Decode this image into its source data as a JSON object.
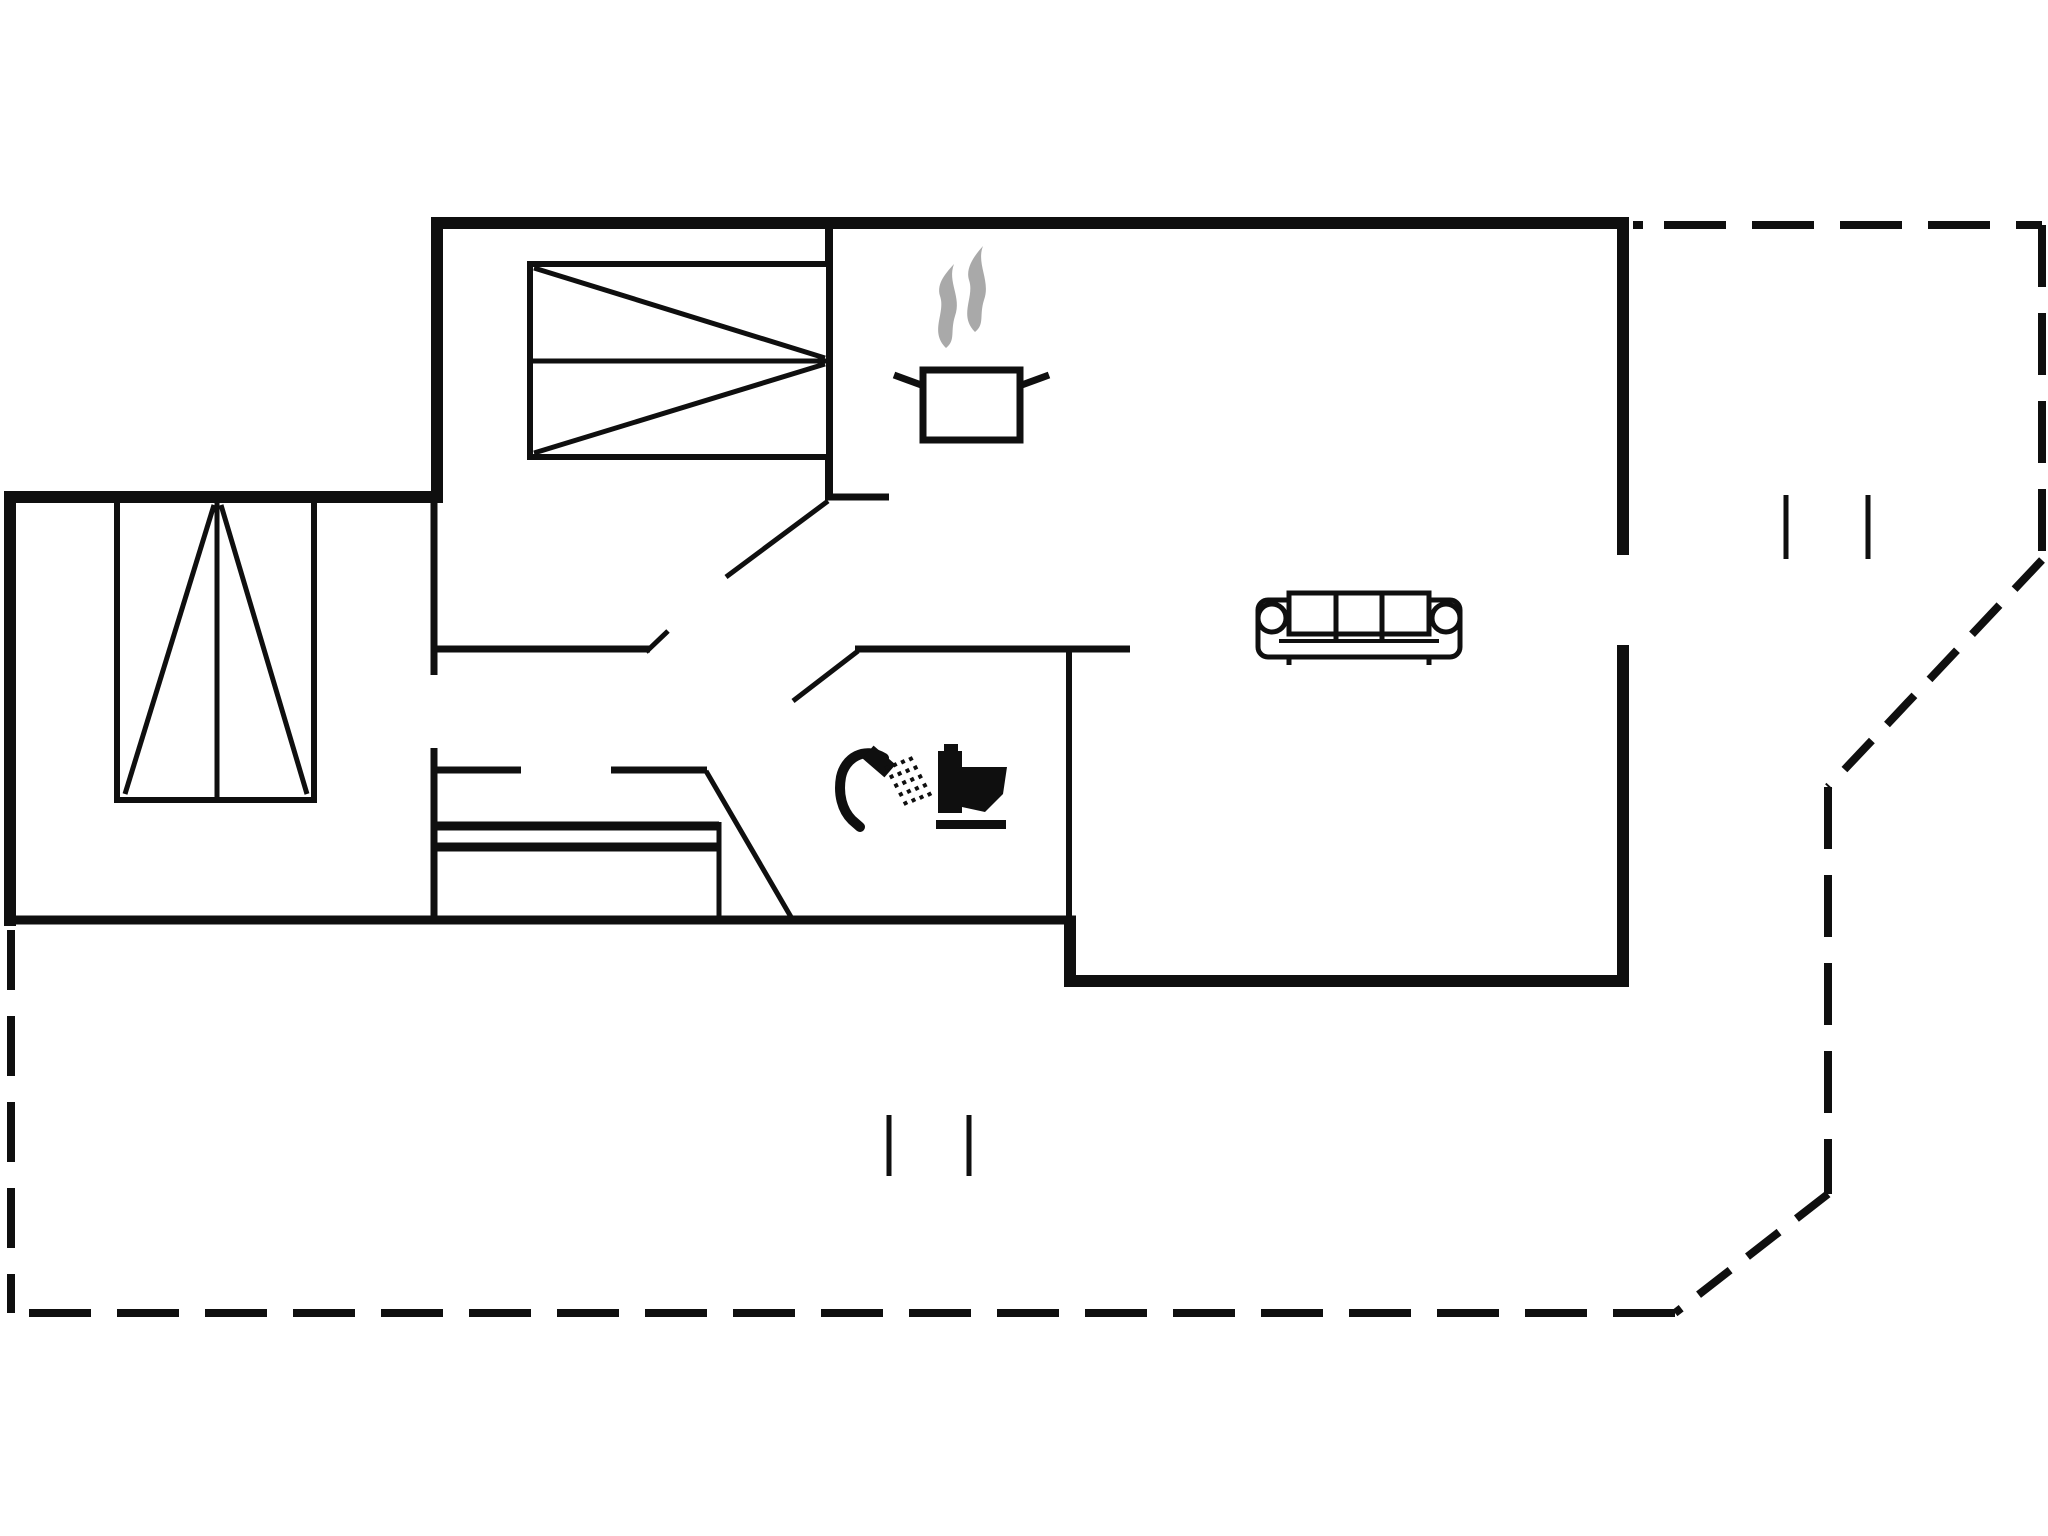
{
  "title": "floor-plan",
  "canvas": {
    "width": 2048,
    "height": 1536,
    "background": "#ffffff",
    "line_color": "#0f0f0f",
    "steam_color": "#a9a9a9"
  },
  "plan": {
    "walls": [
      {
        "x1": 431,
        "y1": 223,
        "x2": 1629,
        "y2": 223,
        "w": 12
      },
      {
        "x1": 437,
        "y1": 217,
        "x2": 437,
        "y2": 503,
        "w": 12
      },
      {
        "x1": 4,
        "y1": 497,
        "x2": 443,
        "y2": 497,
        "w": 12
      },
      {
        "x1": 10,
        "y1": 491,
        "x2": 10,
        "y2": 926,
        "w": 12
      },
      {
        "x1": 4,
        "y1": 920,
        "x2": 1076,
        "y2": 920,
        "w": 9
      },
      {
        "x1": 1070,
        "y1": 916,
        "x2": 1070,
        "y2": 985,
        "w": 12
      },
      {
        "x1": 1064,
        "y1": 981,
        "x2": 1629,
        "y2": 981,
        "w": 12
      },
      {
        "x1": 1623,
        "y1": 217,
        "x2": 1623,
        "y2": 555,
        "w": 12
      },
      {
        "x1": 1623,
        "y1": 645,
        "x2": 1623,
        "y2": 987,
        "w": 12
      },
      {
        "x1": 829,
        "y1": 229,
        "x2": 829,
        "y2": 500,
        "w": 8
      },
      {
        "x1": 827,
        "y1": 497,
        "x2": 889,
        "y2": 497,
        "w": 7
      },
      {
        "x1": 434,
        "y1": 500,
        "x2": 434,
        "y2": 675,
        "w": 7
      },
      {
        "x1": 434,
        "y1": 748,
        "x2": 434,
        "y2": 924,
        "w": 7
      },
      {
        "x1": 431,
        "y1": 649,
        "x2": 650,
        "y2": 649,
        "w": 7
      },
      {
        "x1": 646,
        "y1": 652,
        "x2": 668,
        "y2": 631,
        "w": 5
      },
      {
        "x1": 855,
        "y1": 649,
        "x2": 1130,
        "y2": 649,
        "w": 7
      },
      {
        "x1": 1069,
        "y1": 649,
        "x2": 1069,
        "y2": 924,
        "w": 6
      },
      {
        "x1": 431,
        "y1": 770,
        "x2": 521,
        "y2": 770,
        "w": 7
      },
      {
        "x1": 611,
        "y1": 770,
        "x2": 707,
        "y2": 770,
        "w": 7
      }
    ],
    "doors": [
      {
        "x1": 828,
        "y1": 501,
        "x2": 726,
        "y2": 577,
        "w": 5
      },
      {
        "x1": 858,
        "y1": 651,
        "x2": 793,
        "y2": 701,
        "w": 5
      },
      {
        "x1": 706,
        "y1": 771,
        "x2": 791,
        "y2": 917,
        "w": 5
      }
    ],
    "windows": [
      {
        "x1": 1786,
        "y1": 495,
        "x2": 1786,
        "y2": 559,
        "w": 5
      },
      {
        "x1": 1868,
        "y1": 495,
        "x2": 1868,
        "y2": 559,
        "w": 5
      },
      {
        "x1": 889,
        "y1": 1115,
        "x2": 889,
        "y2": 1176,
        "w": 5
      },
      {
        "x1": 969,
        "y1": 1115,
        "x2": 969,
        "y2": 1176,
        "w": 5
      }
    ],
    "doormat": [
      {
        "x1": 434,
        "y1": 826,
        "x2": 719,
        "y2": 826,
        "w": 9
      },
      {
        "x1": 434,
        "y1": 847,
        "x2": 719,
        "y2": 847,
        "w": 9
      },
      {
        "x1": 719,
        "y1": 822,
        "x2": 719,
        "y2": 918,
        "w": 5
      }
    ],
    "terrace": [
      {
        "x1": 1633,
        "y1": 225,
        "x2": 1643,
        "y2": 225,
        "w": 8,
        "dash": "none"
      },
      {
        "x1": 1664,
        "y1": 225,
        "x2": 2042,
        "y2": 225,
        "w": 8,
        "dash": "62 26"
      },
      {
        "x1": 2042,
        "y1": 225,
        "x2": 2042,
        "y2": 560,
        "w": 8,
        "dash": "62 26"
      },
      {
        "x1": 2042,
        "y1": 560,
        "x2": 1828,
        "y2": 787,
        "w": 8,
        "dash": "40 22"
      },
      {
        "x1": 1828,
        "y1": 787,
        "x2": 1828,
        "y2": 1194,
        "w": 8,
        "dash": "62 26"
      },
      {
        "x1": 1828,
        "y1": 1194,
        "x2": 1675,
        "y2": 1313,
        "w": 8,
        "dash": "40 22"
      },
      {
        "x1": 1675,
        "y1": 1313,
        "x2": 25,
        "y2": 1313,
        "w": 8,
        "dash": "62 26"
      },
      {
        "x1": 11,
        "y1": 930,
        "x2": 11,
        "y2": 1313,
        "w": 8,
        "dash": "60 26"
      }
    ]
  },
  "furniture": [
    {
      "name": "double-bed-icon",
      "prims": [
        {
          "t": "rect",
          "x": 530,
          "y": 264,
          "w": 299,
          "h": 193,
          "sw": 6,
          "fill": "#ffffff"
        },
        {
          "t": "line",
          "x1": 530,
          "y1": 361,
          "x2": 829,
          "y2": 361,
          "sw": 5
        },
        {
          "t": "line",
          "x1": 534,
          "y1": 268,
          "x2": 825,
          "y2": 358,
          "sw": 5
        },
        {
          "t": "line",
          "x1": 534,
          "y1": 453,
          "x2": 825,
          "y2": 364,
          "sw": 5
        }
      ]
    },
    {
      "name": "wardrobe-icon",
      "prims": [
        {
          "t": "rect",
          "x": 117,
          "y": 500,
          "w": 197,
          "h": 300,
          "sw": 6,
          "fill": "#ffffff"
        },
        {
          "t": "line",
          "x1": 217,
          "y1": 500,
          "x2": 217,
          "y2": 800,
          "sw": 5
        },
        {
          "t": "line",
          "x1": 125,
          "y1": 794,
          "x2": 214,
          "y2": 505,
          "sw": 5
        },
        {
          "t": "line",
          "x1": 221,
          "y1": 505,
          "x2": 307,
          "y2": 794,
          "sw": 5
        }
      ]
    },
    {
      "name": "steam-icon",
      "prims": [
        {
          "t": "path",
          "d": "M946,348 C929,331 946,313 940,296 C936,283 947,272 954,264 C947,282 962,297 955,316 C950,332 956,340 946,348 Z",
          "fill": "steam",
          "sw": 0
        },
        {
          "t": "path",
          "d": "M975,332 C958,315 975,297 969,280 C965,267 976,254 983,246 C976,264 991,281 984,300 C979,316 985,324 975,332 Z",
          "fill": "steam",
          "sw": 0
        }
      ]
    },
    {
      "name": "cooking-pot-icon",
      "prims": [
        {
          "t": "line",
          "x1": 924,
          "y1": 386,
          "x2": 894,
          "y2": 375,
          "sw": 7
        },
        {
          "t": "line",
          "x1": 1019,
          "y1": 386,
          "x2": 1049,
          "y2": 375,
          "sw": 7
        },
        {
          "t": "rect",
          "x": 923,
          "y": 370,
          "w": 97,
          "h": 70,
          "sw": 7,
          "fill": "#ffffff"
        }
      ]
    },
    {
      "name": "sofa-icon",
      "prims": [
        {
          "t": "rect",
          "x": 1258,
          "y": 600,
          "w": 202,
          "h": 57,
          "rx": 10,
          "sw": 5,
          "fill": "#ffffff"
        },
        {
          "t": "line",
          "x1": 1289,
          "y1": 657,
          "x2": 1289,
          "y2": 665,
          "sw": 5
        },
        {
          "t": "line",
          "x1": 1429,
          "y1": 657,
          "x2": 1429,
          "y2": 665,
          "sw": 5
        },
        {
          "t": "rect",
          "x": 1289,
          "y": 593,
          "w": 140,
          "h": 41,
          "sw": 5,
          "fill": "#ffffff"
        },
        {
          "t": "line",
          "x1": 1336,
          "y1": 593,
          "x2": 1336,
          "y2": 641,
          "sw": 5
        },
        {
          "t": "line",
          "x1": 1382,
          "y1": 593,
          "x2": 1382,
          "y2": 641,
          "sw": 5
        },
        {
          "t": "line",
          "x1": 1279,
          "y1": 641,
          "x2": 1439,
          "y2": 641,
          "sw": 4
        },
        {
          "t": "circle",
          "cx": 1272,
          "cy": 618,
          "r": 14,
          "sw": 5,
          "fill": "#ffffff"
        },
        {
          "t": "circle",
          "cx": 1446,
          "cy": 618,
          "r": 14,
          "sw": 5,
          "fill": "#ffffff"
        }
      ]
    },
    {
      "name": "shower-icon",
      "prims": [
        {
          "t": "path",
          "d": "M884,758 C864,746 845,758 841,777 C838,794 842,810 852,820 L860,827",
          "sw": 10,
          "fill": "none",
          "cap": "round"
        },
        {
          "t": "line",
          "x1": 868,
          "y1": 752,
          "x2": 890,
          "y2": 771,
          "sw": 17
        },
        {
          "t": "line",
          "x1": 886,
          "y1": 766,
          "x2": 908,
          "y2": 808,
          "sw": 4,
          "dash": "4 6"
        },
        {
          "t": "line",
          "x1": 894,
          "y1": 763,
          "x2": 916,
          "y2": 805,
          "sw": 4,
          "dash": "4 6"
        },
        {
          "t": "line",
          "x1": 902,
          "y1": 760,
          "x2": 924,
          "y2": 802,
          "sw": 4,
          "dash": "4 6"
        },
        {
          "t": "line",
          "x1": 910,
          "y1": 757,
          "x2": 932,
          "y2": 799,
          "sw": 4,
          "dash": "4 6"
        }
      ]
    },
    {
      "name": "toilet-icon",
      "prims": [
        {
          "t": "rect",
          "x": 938,
          "y": 751,
          "w": 24,
          "h": 62,
          "sw": 0,
          "fill": "line"
        },
        {
          "t": "rect",
          "x": 944,
          "y": 744,
          "w": 14,
          "h": 8,
          "sw": 0,
          "fill": "line"
        },
        {
          "t": "poly",
          "points": "962,767 1007,767 1003,794 985,812 962,807",
          "sw": 0,
          "fill": "line"
        },
        {
          "t": "rect",
          "x": 936,
          "y": 820,
          "w": 70,
          "h": 9,
          "sw": 0,
          "fill": "line"
        }
      ]
    }
  ]
}
